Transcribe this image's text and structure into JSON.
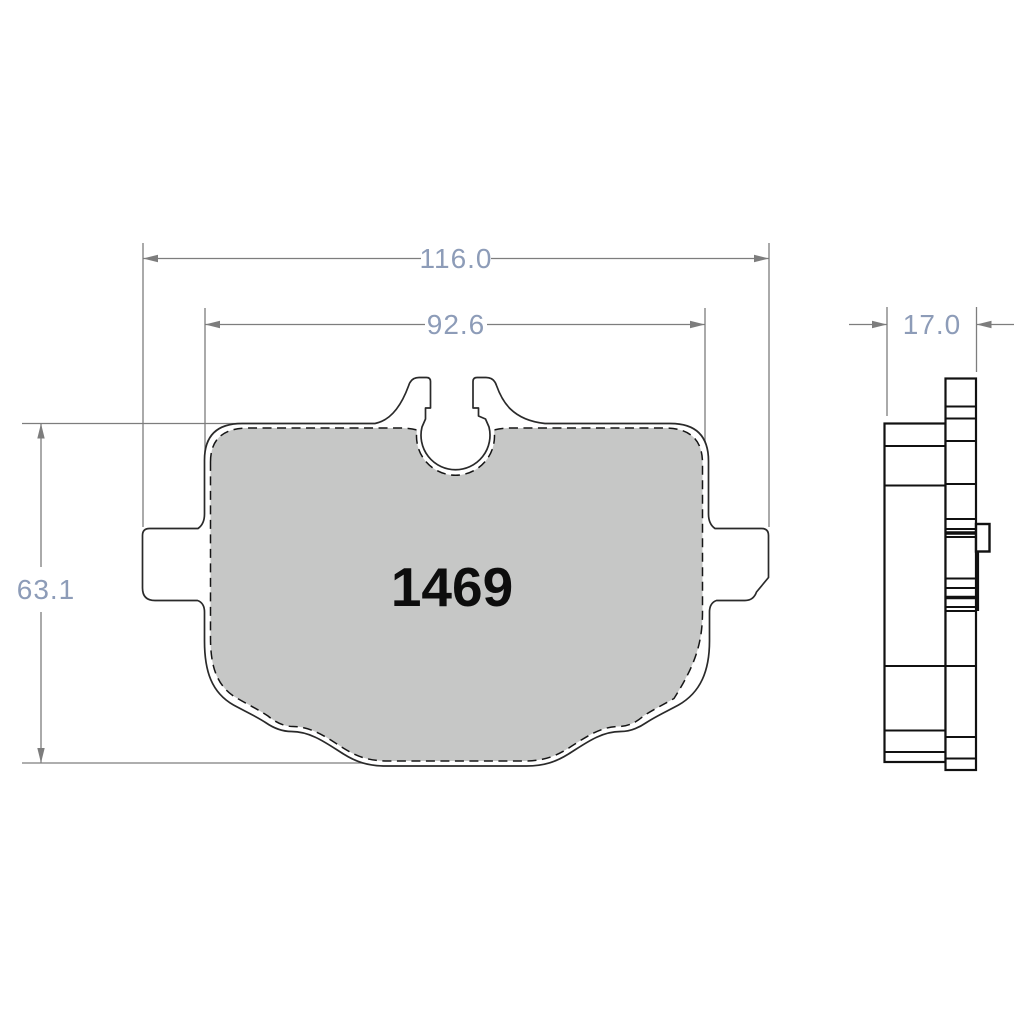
{
  "drawing": {
    "part_number": "1469",
    "type": "brake-pad-technical-drawing",
    "views": [
      "front",
      "side-profile"
    ]
  },
  "dimensions": {
    "overall_width": "116.0",
    "friction_width": "92.6",
    "height": "63.1",
    "thickness": "17.0"
  },
  "colors": {
    "background": "#ffffff",
    "outline": "#2a2a2a",
    "friction_fill": "#c6c7c6",
    "dimension_line": "#7d7d7d",
    "dimension_text": "#8d9cb8",
    "part_number_text": "#0d0d0d"
  }
}
